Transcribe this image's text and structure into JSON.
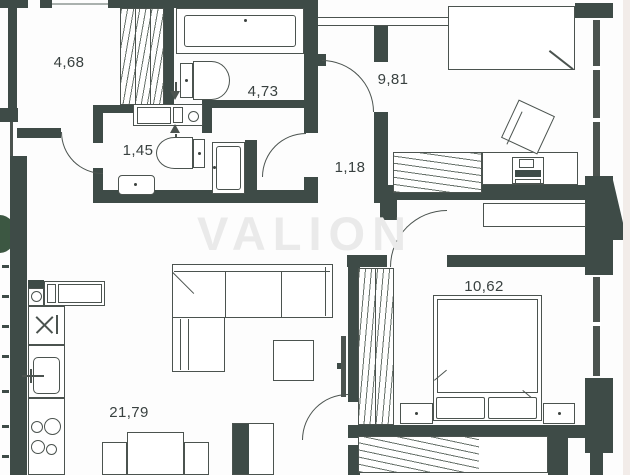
{
  "watermark": {
    "text": "VALION"
  },
  "rooms": [
    {
      "id": "storage-room",
      "area_label": "4,68"
    },
    {
      "id": "bathroom",
      "area_label": "4,73"
    },
    {
      "id": "wc",
      "area_label": "1,45"
    },
    {
      "id": "hallway",
      "area_label": "1,18"
    },
    {
      "id": "bedroom-small",
      "area_label": "9,81"
    },
    {
      "id": "bedroom-main",
      "area_label": "10,62"
    },
    {
      "id": "kitchen-living-room",
      "area_label": "21,79"
    }
  ],
  "colors": {
    "wall": "#3e4b47",
    "line": "#4b534f",
    "background": "#fdfdfd",
    "paper_edge": "#f2ece9",
    "vegetation": "#3c5742",
    "watermark": "#eaeaea"
  }
}
